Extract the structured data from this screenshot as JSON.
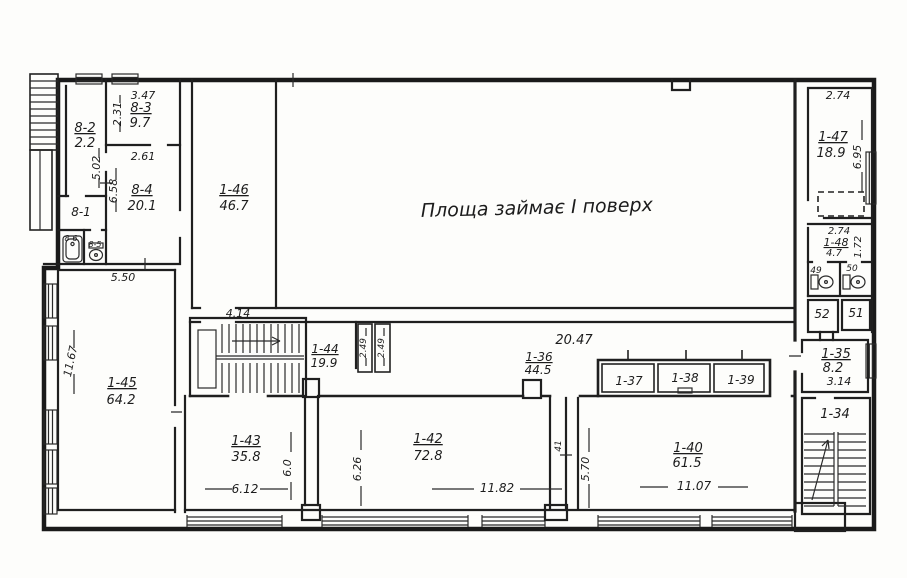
{
  "doc": {
    "type": "scanned architectural floor plan",
    "note": "Площа займає I поверх"
  },
  "rooms": {
    "r8_1": {
      "id": "8-1"
    },
    "r8_2": {
      "id": "8-2",
      "area": "2.2"
    },
    "r8_3": {
      "id": "8-3",
      "area": "9.7"
    },
    "r8_4": {
      "id": "8-4",
      "area": "20.1"
    },
    "r8_5": {
      "id": "8-5"
    },
    "r8_6": {
      "id": "8-6"
    },
    "r1_34": {
      "id": "1-34"
    },
    "r1_35": {
      "id": "1-35",
      "area": "8.2"
    },
    "r1_36": {
      "id": "1-36",
      "area": "44.5"
    },
    "r1_37": {
      "id": "1-37"
    },
    "r1_38": {
      "id": "1-38"
    },
    "r1_39": {
      "id": "1-39"
    },
    "r1_40": {
      "id": "1-40",
      "area": "61.5"
    },
    "r41": {
      "id": "41"
    },
    "r1_42": {
      "id": "1-42",
      "area": "72.8"
    },
    "r1_43": {
      "id": "1-43",
      "area": "35.8"
    },
    "r1_44": {
      "id": "1-44",
      "area": "19.9"
    },
    "r1_45": {
      "id": "1-45",
      "area": "64.2"
    },
    "r1_46": {
      "id": "1-46",
      "area": "46.7"
    },
    "r1_47": {
      "id": "1-47",
      "area": "18.9"
    },
    "r1_48": {
      "id": "1-48",
      "area": "4.7"
    },
    "r49": {
      "id": "49"
    },
    "r50": {
      "id": "50"
    },
    "r51": {
      "id": "51"
    },
    "r52": {
      "id": "52"
    }
  },
  "dims": {
    "d_3_47": "3.47",
    "d_2_31": "2.31",
    "d_2_61": "2.61",
    "d_5_02": "5.02",
    "d_6_58": "6.58",
    "d_5_50": "5.50",
    "d_11_67": "11.67",
    "d_4_14": "4.14",
    "d_2_49_a": "2.49",
    "d_2_49_b": "2.49",
    "d_20_47": "20.47",
    "d_6_12": "6.12",
    "d_6_0": "6.0",
    "d_6_26": "6.26",
    "d_11_82": "11.82",
    "d_5_70": "5.70",
    "d_11_07": "11.07",
    "d_2_74_a": "2.74",
    "d_6_95": "6.95",
    "d_2_74_b": "2.74",
    "d_1_72": "1.72",
    "d_3_14": "3.14"
  },
  "colors": {
    "ink": "#1c1c1c",
    "paper": "#fdfdfb"
  }
}
